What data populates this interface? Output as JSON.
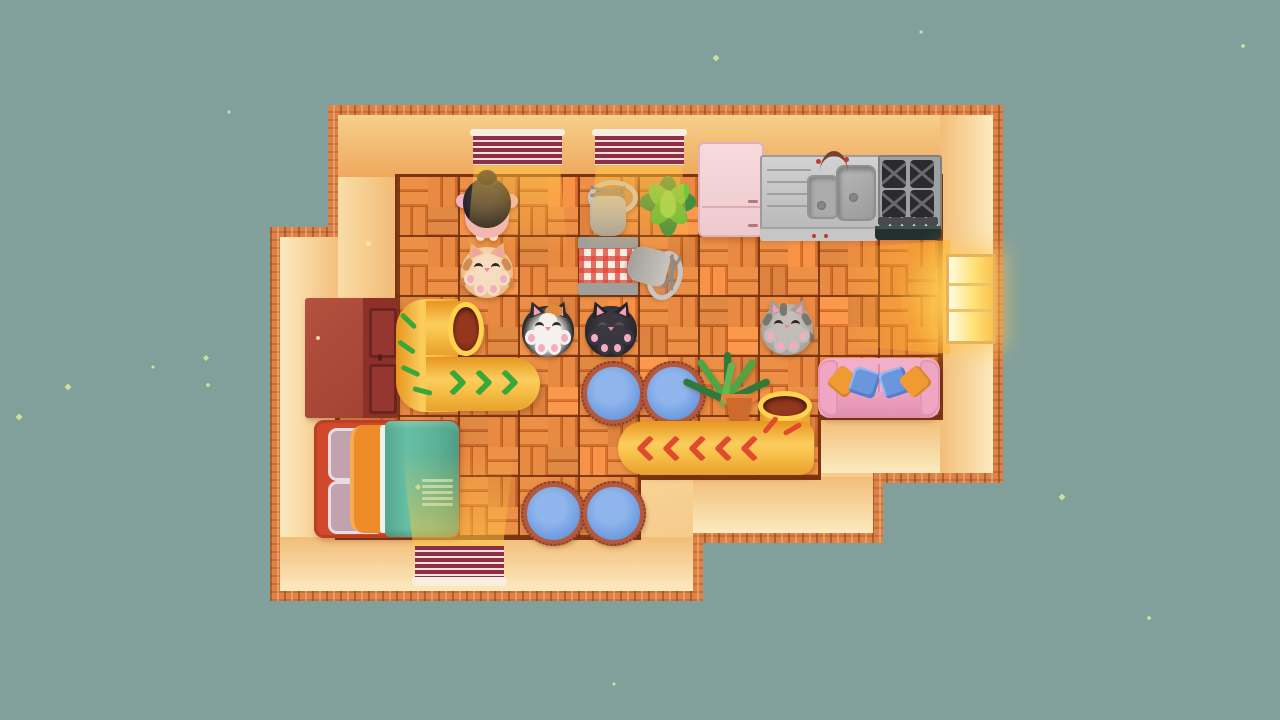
{
  "scene": {
    "description": "Top-down cozy house game scene with sleeping cats, cat tunnels and furniture",
    "background_color": "#82a09b",
    "sparkle_color": "#cfe49b",
    "sparkles": [
      [
        229,
        112,
        4
      ],
      [
        206,
        358,
        6
      ],
      [
        153,
        367,
        4
      ],
      [
        68,
        387,
        7
      ],
      [
        208,
        385,
        5
      ],
      [
        19,
        417,
        7
      ],
      [
        716,
        58,
        7
      ],
      [
        921,
        32,
        4
      ],
      [
        1243,
        46,
        5
      ],
      [
        1062,
        497,
        7
      ],
      [
        1149,
        618,
        5
      ],
      [
        614,
        684,
        4
      ]
    ],
    "wall_dots": [
      [
        368,
        243
      ],
      [
        318,
        338
      ]
    ],
    "house": {
      "wall_border_color": "#dd8348",
      "wall_color": "#f8dca4",
      "floor_plank_light": "#ec9047",
      "floor_plank_dark": "#c05f24",
      "floor_grout_color": "#7d3413",
      "tile_size_px": 60
    },
    "windows": {
      "top_blind_count": 2,
      "bottom_blind_count": 1,
      "blind_stripe_color": "#8e2e4a",
      "blind_bar_color": "#f6eede",
      "right_window": {
        "label": "lit side window",
        "glow_color": "#ffd24f",
        "pane_count": 3
      }
    },
    "kitchen": {
      "fridge": {
        "label": "pink refrigerator",
        "color": "#f4d7d8"
      },
      "sink": {
        "label": "stainless double sink with drainboard and faucet"
      },
      "stove": {
        "label": "gas stove with oven",
        "burner_count": 4
      }
    },
    "furniture": {
      "wardrobe": {
        "label": "dark red wardrobe",
        "color": "#a84435"
      },
      "bed": {
        "label": "bed with teal blanket and orange ruffled quilt",
        "blanket_color": "#5db398",
        "frame_color": "#d0492c"
      },
      "couch": {
        "label": "pink couch with blue and orange pillows",
        "color": "#f3afc9"
      },
      "plaid_stool": {
        "label": "stool with red gingham cushion"
      },
      "fallen_chairs": {
        "label": "tipped-over grey chairs",
        "count": 2
      },
      "floor_cushions": {
        "label": "round blue quilted floor cushions",
        "count": 4,
        "color": "#6f9ce0",
        "fringe_color": "#b3593d"
      },
      "plants": {
        "label": "green house plants",
        "count": 2
      }
    },
    "tunnels": [
      {
        "label": "yellow cat tunnel with green chevrons",
        "shape": "C-bend, opening facing right",
        "chevron_color": "#3aa838"
      },
      {
        "label": "yellow cat tunnel with red chevrons",
        "shape": "L-bend, opening facing up",
        "chevron_color": "#e04a2e"
      }
    ],
    "characters": {
      "person": {
        "label": "person with black hair bun lying on floor",
        "shirt_color": "#f2b4c2"
      },
      "cats": [
        {
          "label": "orange tabby cat sleeping belly-up"
        },
        {
          "label": "calico cat sleeping belly-up"
        },
        {
          "label": "black cat sleeping belly-up"
        },
        {
          "label": "grey tabby cat sleeping belly-up"
        }
      ]
    }
  }
}
